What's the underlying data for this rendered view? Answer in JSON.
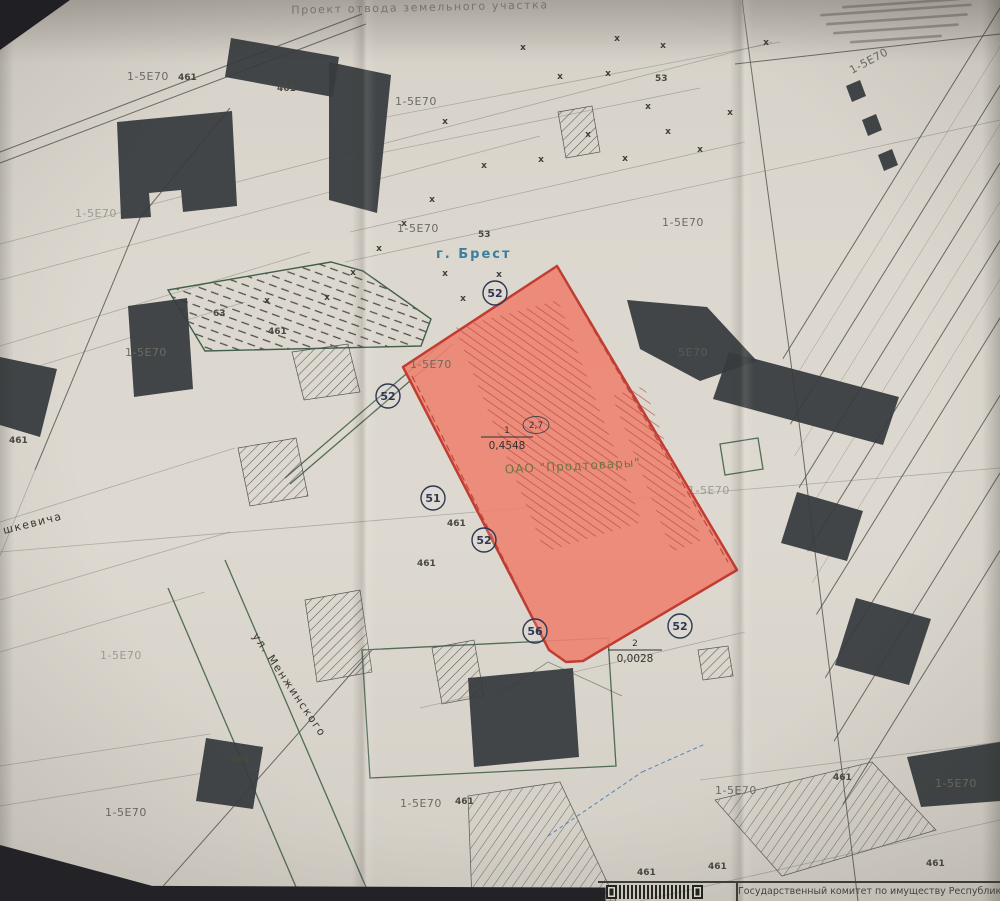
{
  "title": "Проект отвода земельного участка",
  "footer": {
    "agency": "Государственный комитет по имуществу Республики Беларус"
  },
  "colors": {
    "paper": "#dcd8cf",
    "parcel_fill": "#ed8370",
    "parcel_border": "#c23c31",
    "ink": "#37373f",
    "green_boundary": "#41604a",
    "city_label_blue": "#3a7f9f",
    "owner_label_olive": "#6f7540"
  },
  "map": {
    "city": {
      "text": "г. Брест",
      "x": 436,
      "y": 258
    },
    "parcel": {
      "owner": {
        "text": "ОАО \"Продтовары\"",
        "x": 573,
        "y": 470,
        "rot": -3
      },
      "area_main": {
        "num": "1",
        "value": "0,4548",
        "x": 507,
        "y": 437,
        "hw": 26
      },
      "area_secondary": {
        "num": "2",
        "value": "0,0028",
        "x": 635,
        "y": 650,
        "hw": 27
      },
      "note": {
        "text": "2,7",
        "x": 536,
        "y": 425
      }
    },
    "points": [
      {
        "n": "52",
        "x": 495,
        "y": 293
      },
      {
        "n": "52",
        "x": 388,
        "y": 396
      },
      {
        "n": "51",
        "x": 433,
        "y": 498
      },
      {
        "n": "52",
        "x": 484,
        "y": 540
      },
      {
        "n": "56",
        "x": 535,
        "y": 631
      },
      {
        "n": "52",
        "x": 680,
        "y": 626
      }
    ],
    "zone_labels": [
      {
        "text": "1-5Е70",
        "x": 127,
        "y": 80
      },
      {
        "text": "1-5Е70",
        "x": 75,
        "y": 217,
        "faint": true
      },
      {
        "text": "1-5Е70",
        "x": 395,
        "y": 105
      },
      {
        "text": "1-5Е70",
        "x": 397,
        "y": 232
      },
      {
        "text": "1-5Е70",
        "x": 662,
        "y": 226
      },
      {
        "text": "1-5Е70",
        "x": 125,
        "y": 356
      },
      {
        "text": "1-5Е70",
        "x": 410,
        "y": 368
      },
      {
        "text": "5Е70",
        "x": 678,
        "y": 356,
        "faint": true
      },
      {
        "text": "1-5Е70",
        "x": 688,
        "y": 494,
        "faint": true
      },
      {
        "text": "1-5Е70",
        "x": 100,
        "y": 659,
        "faint": true
      },
      {
        "text": "1-5Е70",
        "x": 105,
        "y": 816
      },
      {
        "text": "1-5Е70",
        "x": 400,
        "y": 807
      },
      {
        "text": "1-5Е70",
        "x": 715,
        "y": 794
      },
      {
        "text": "1-5Е70",
        "x": 935,
        "y": 787
      },
      {
        "text": "1-5Е70",
        "x": 852,
        "y": 74,
        "rot": -28
      }
    ],
    "misc_labels": [
      {
        "text": "461",
        "x": 178,
        "y": 80
      },
      {
        "text": "461",
        "x": 277,
        "y": 91
      },
      {
        "text": "461",
        "x": 268,
        "y": 334
      },
      {
        "text": "461",
        "x": 9,
        "y": 443
      },
      {
        "text": "461",
        "x": 447,
        "y": 526
      },
      {
        "text": "461",
        "x": 417,
        "y": 566
      },
      {
        "text": "461",
        "x": 231,
        "y": 762
      },
      {
        "text": "461",
        "x": 455,
        "y": 804
      },
      {
        "text": "461",
        "x": 637,
        "y": 875
      },
      {
        "text": "461",
        "x": 708,
        "y": 869
      },
      {
        "text": "461",
        "x": 833,
        "y": 780
      },
      {
        "text": "461",
        "x": 926,
        "y": 866
      },
      {
        "text": "53",
        "x": 655,
        "y": 81
      },
      {
        "text": "53",
        "x": 478,
        "y": 237
      },
      {
        "text": "63",
        "x": 213,
        "y": 316
      }
    ],
    "streets": [
      {
        "text": "ул. Менжинского",
        "x": 252,
        "y": 636,
        "rot": 56
      },
      {
        "text": "шкевича",
        "x": 4,
        "y": 534,
        "rot": -14
      }
    ],
    "crosses": [
      [
        523,
        50
      ],
      [
        617,
        41
      ],
      [
        663,
        48
      ],
      [
        560,
        79
      ],
      [
        608,
        76
      ],
      [
        445,
        124
      ],
      [
        648,
        109
      ],
      [
        730,
        115
      ],
      [
        766,
        45
      ],
      [
        588,
        137
      ],
      [
        541,
        162
      ],
      [
        484,
        168
      ],
      [
        625,
        161
      ],
      [
        668,
        134
      ],
      [
        700,
        152
      ],
      [
        432,
        202
      ],
      [
        404,
        226
      ],
      [
        379,
        251
      ],
      [
        353,
        275
      ],
      [
        327,
        300
      ],
      [
        267,
        303
      ],
      [
        445,
        276
      ],
      [
        463,
        301
      ],
      [
        499,
        277
      ]
    ],
    "fine_print_bars": [
      [
        842,
        6,
        118
      ],
      [
        820,
        14,
        152
      ],
      [
        826,
        23,
        142
      ],
      [
        833,
        32,
        126
      ],
      [
        850,
        41,
        92
      ]
    ]
  }
}
